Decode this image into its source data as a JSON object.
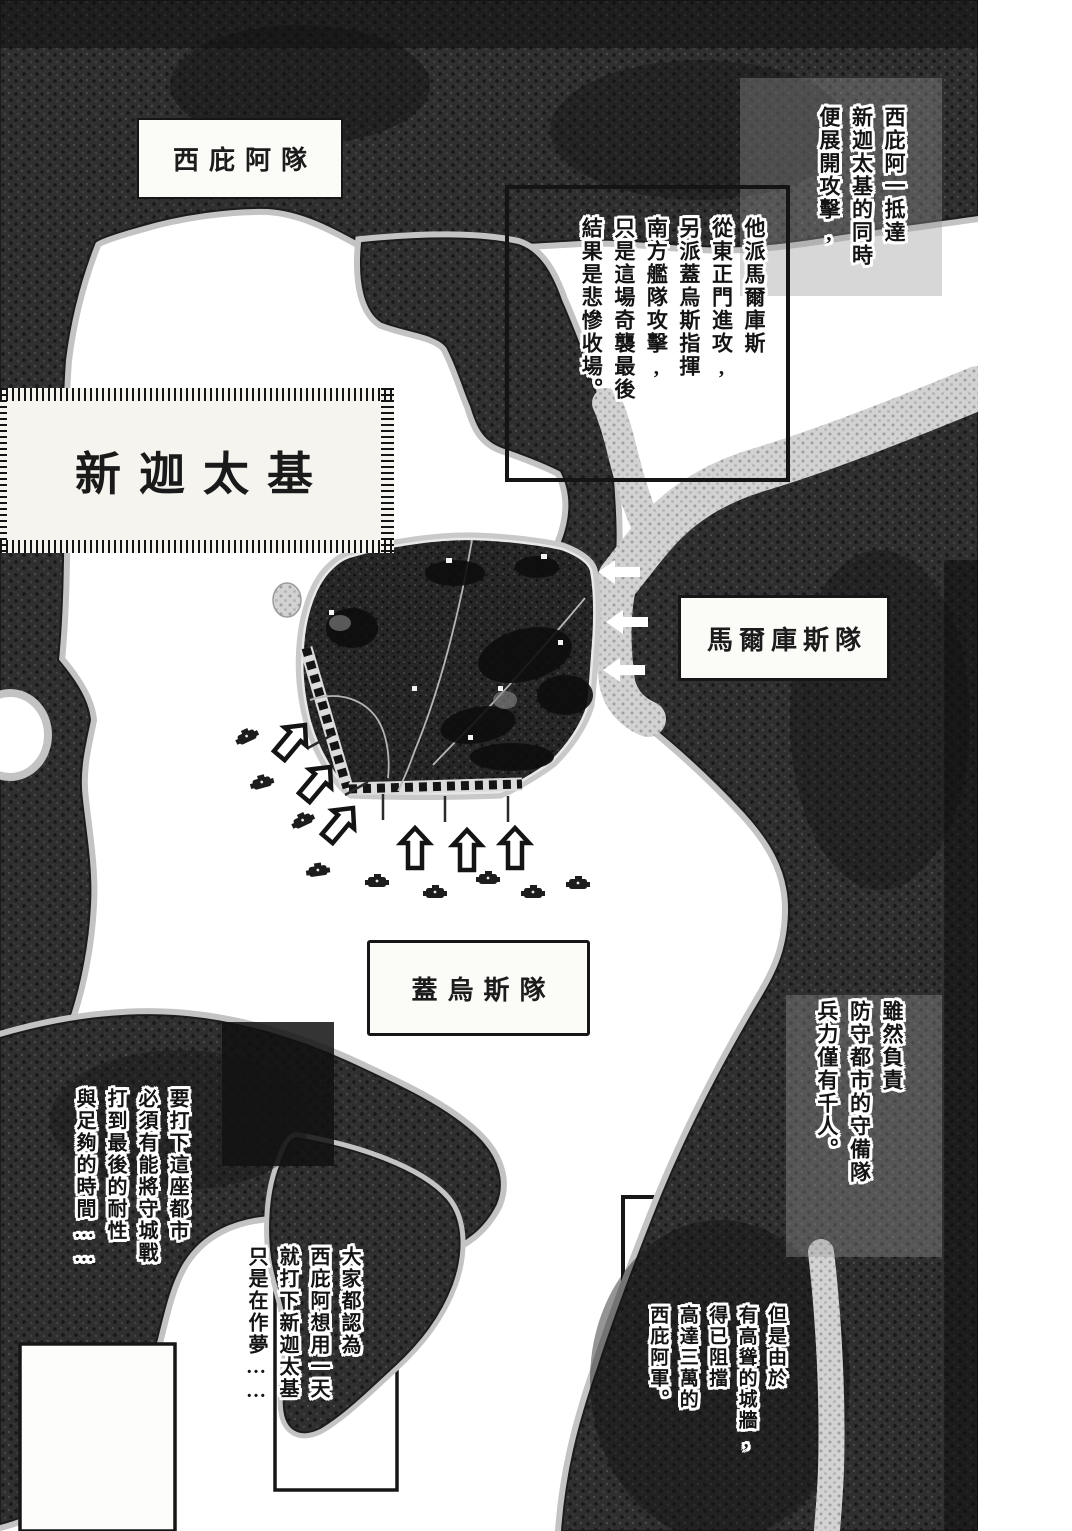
{
  "labels": {
    "city_banner": "新迦太基",
    "scipio_unit": "西庇阿隊",
    "marcus_unit": "馬爾庫斯隊",
    "gaius_unit": "蓋烏斯隊"
  },
  "narration": {
    "scipio_attack": "西庇阿一抵達\n新迦太基的同時\n便展開攻擊,",
    "battle_plan": "他派馬爾庫斯\n從東正門進攻,\n另派蓋烏斯指揮\n南方艦隊攻擊,\n只是這場奇襲最後\n結果是悲慘收場。",
    "garrison": "雖然負責\n防守都市的守備隊\n兵力僅有千人。",
    "city_walls": "但是由於\n有高聳的城牆,\n得已阻擋\n高達三萬的\n西庇阿軍。",
    "siege_patience": "要打下這座都市\n必須有能將守城戰\n打到最後的耐性\n與足夠的時間……",
    "dream": "大家都認為\n西庇阿想用一天\n就打下新迦太基\n只是在作夢……"
  },
  "icons": {
    "east_attack_arrows": "white-left-arrow × 3",
    "west_assault_arrows": "outlined-northeast-arrow × 3",
    "south_assault_arrows": "outlined-up-arrow × 3",
    "unit_markers": "small-dark-unit-marker × 9"
  },
  "colors": {
    "ink": "#141414",
    "paper": "#ffffff",
    "terrain": "#2f2f2f",
    "coast_halo": "#c3c3c3",
    "river": "#d2d2d2"
  }
}
